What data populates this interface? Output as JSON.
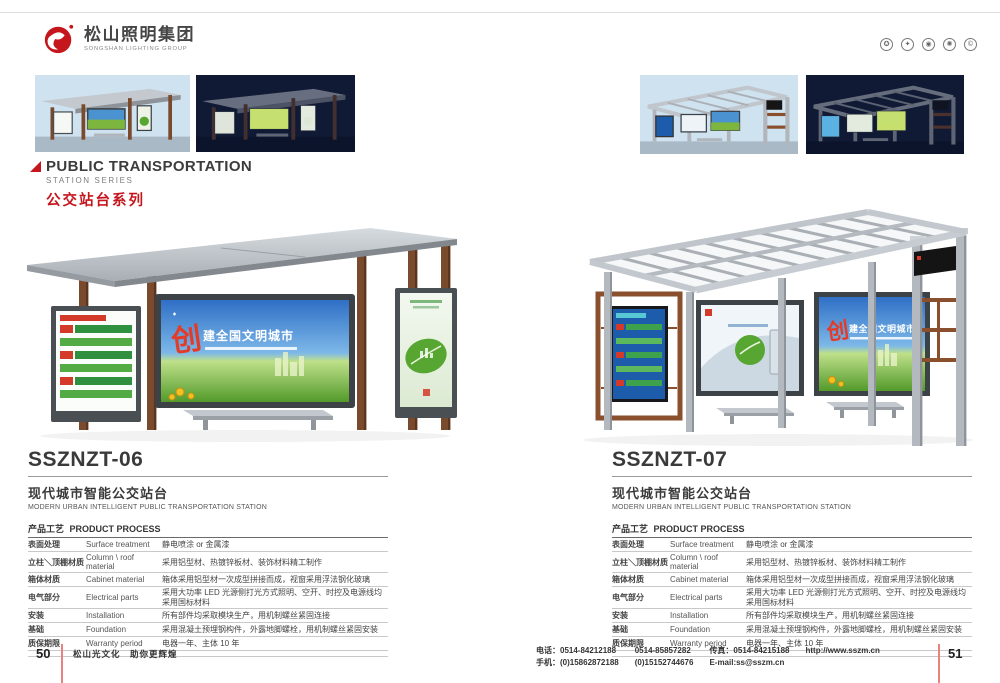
{
  "header": {
    "logo_cn": "松山照明集团",
    "logo_en": "SONGSHAN LIGHTING GROUP",
    "cert_glyphs": [
      "✪",
      "✦",
      "◉",
      "✺",
      "©"
    ]
  },
  "series_heading": {
    "en": "PUBLIC TRANSPORTATION",
    "sub": "STATION SERIES",
    "cn": "公交站台系列"
  },
  "products": [
    {
      "model": "SSZNZT-06",
      "title_cn": "现代城市智能公交站台",
      "title_en": "MODERN URBAN INTELLIGENT PUBLIC TRANSPORTATION STATION"
    },
    {
      "model": "SSZNZT-07",
      "title_cn": "现代城市智能公交站台",
      "title_en": "MODERN URBAN INTELLIGENT PUBLIC TRANSPORTATION STATION"
    }
  ],
  "process_table": {
    "title_cn": "产品工艺",
    "title_en": "PRODUCT PROCESS",
    "rows": [
      {
        "cn": "表面处理",
        "en": "Surface treatment",
        "value": "静电喷涂 or 金属漆"
      },
      {
        "cn": "立柱＼顶棚材质",
        "en": "Column \\ roof material",
        "value": "采用铝型材、热镀锌板材、装饰材料精工制作"
      },
      {
        "cn": "箱体材质",
        "en": "Cabinet material",
        "value": "箱体采用铝型材一次成型拼接而成，视窗采用浮法钢化玻璃"
      },
      {
        "cn": "电气部分",
        "en": "Electrical parts",
        "value": "采用大功率 LED 光源侧打光方式照明、空开、时控及电源线均采用国标材料"
      },
      {
        "cn": "安装",
        "en": "Installation",
        "value": "所有部件均采取模块生产，用机制螺丝紧固连接"
      },
      {
        "cn": "基础",
        "en": "Foundation",
        "value": "采用混凝土预埋钢构件，外露地脚螺栓，用机制螺丝紧固安装"
      },
      {
        "cn": "质保期限",
        "en": "Warranty period",
        "value": "电器一年、主体 10 年"
      }
    ]
  },
  "billboard": {
    "lead": "创",
    "slogan": "建全国文明城市"
  },
  "footer": {
    "page_left": "50",
    "slogan": "松山光文化　助你更辉煌",
    "phone_line": "电话：0514-84212188",
    "phone2": "0514-85857282",
    "fax": "传真：0514-84215188",
    "mobile_line": "手机：(0)15862872188",
    "mobile2": "(0)15152744676",
    "email": "E-mail:ss@sszm.cn",
    "website": "http://www.sszm.cn",
    "page_right": "51"
  },
  "colors": {
    "brand_red": "#c5161d",
    "rule_red": "#e8827e"
  }
}
